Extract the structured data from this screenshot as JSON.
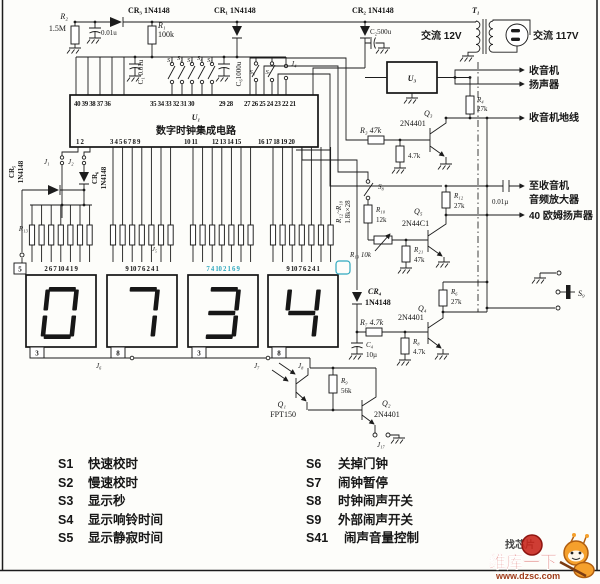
{
  "top": {
    "r2_name": "R₂",
    "r2_val": "1.5M",
    "c0_val": "0.01u",
    "cr3": "CR₃ 1N4148",
    "cr1": "CR₁ 1N4148",
    "cr2": "CR₂ 1N4148",
    "r1_name": "R₁",
    "r1_val": "100k",
    "c1_label": "C₁ 0.01u",
    "c6_label": "C₆1000u",
    "switches": [
      "S₁",
      "S₂",
      "S₃",
      "S₄",
      "S₅"
    ],
    "s6": "S₆",
    "s7": "S₇",
    "j4": "J₄",
    "c2_label": "C₂500u",
    "ac12": "交流 12V",
    "t1": "T₁",
    "ac117": "交流 117V",
    "u3": "U₃"
  },
  "ic": {
    "name": "U₁",
    "title": "数字时钟集成电路",
    "top_pins": [
      "40 39 38 37 36",
      "35 34 33 32 31 30",
      "29 28",
      "27 26 25 24 23 22 21"
    ],
    "bottom_pins": [
      "1 2",
      "3 4 5 6 7 8 9",
      "10 11",
      "12 13 14 15",
      "16 17 18 19 20"
    ]
  },
  "left": {
    "j1": "J₁",
    "j2": "J₂",
    "cr5_name": "CR₅",
    "cr5_val": "1N4148",
    "cr6_name": "CR₆",
    "cr6_val": "1N4148",
    "r13": "R₁₃",
    "pin5": "5"
  },
  "bank": {
    "range": "R₁₂~R₁₈",
    "mult": "1.8k×28",
    "j5": "J₅"
  },
  "display": {
    "value": "0734",
    "top_pins": [
      "2 6 7 10 4 1 9",
      "9 10 7 6 2 4 1",
      "7 4 10 2 1 6 9",
      "9 10 7 6 2 4 1"
    ],
    "bottom_pins": [
      "3",
      "8",
      "3",
      "8"
    ],
    "j6": "J₆",
    "j7": "J₇",
    "j8": "J₈"
  },
  "amp": {
    "q3_name": "Q₃",
    "q3_type": "2N4401",
    "r4_name": "R₄",
    "r4_val": "27k",
    "r3_label": "R₃ 47k",
    "r5_val": "4.7k",
    "s8": "S₈",
    "r10_name": "R₁₀",
    "r10_val": "12k",
    "r19_label": "R₁₉ 10k",
    "r21_name": "R₂₁",
    "r21_val": "47k",
    "q5_name": "Q₅",
    "q5_type": "2N44C1",
    "r12_name": "R₁₂",
    "r12_val": "27k",
    "c5_val": "0.01µ",
    "cr4_name": "CR₄",
    "cr4_val": "1N4148",
    "r7_label": "R₇ 4.7k",
    "q4_name": "Q₄",
    "q4_type": "2N4401",
    "r6_name": "R₆",
    "r6_val": "27k",
    "c4_name": "C₄",
    "c4_val": "10µ",
    "r8_name": "R₈",
    "r8_val": "4.7k",
    "s9": "S₉"
  },
  "photo": {
    "q1_name": "Q₁",
    "q1_type": "FPT150",
    "r9_name": "R₉",
    "r9_val": "56k",
    "q2_name": "Q₂",
    "q2_type": "2N4401",
    "j17": "J₁₇"
  },
  "outputs": {
    "radio1": "收音机",
    "radio2": "扬声器",
    "ground": "收音机地线",
    "amp1": "至收音机",
    "amp2": "音频放大器",
    "speaker": "40 欧姆扬声器"
  },
  "legend": {
    "left": [
      {
        "id": "S1",
        "text": "快速校时"
      },
      {
        "id": "S2",
        "text": "慢速校时"
      },
      {
        "id": "S3",
        "text": "显示秒"
      },
      {
        "id": "S4",
        "text": "显示响铃时间"
      },
      {
        "id": "S5",
        "text": "显示静寂时间"
      }
    ],
    "right": [
      {
        "id": "S6",
        "text": "关掉门钟"
      },
      {
        "id": "S7",
        "text": "闹钟暂停"
      },
      {
        "id": "S8",
        "text": "时钟闹声开关"
      },
      {
        "id": "S9",
        "text": "外部闹声开关"
      },
      {
        "id": "S41",
        "text": "闹声音量控制"
      }
    ]
  },
  "watermark": {
    "badge": "找芯片",
    "brand": "维库一下",
    "url": "www.dzsc.com",
    "brand_color": "#c9281e",
    "mascot_color": "#f5a02c",
    "stamp_color": "#2fa8bf"
  }
}
